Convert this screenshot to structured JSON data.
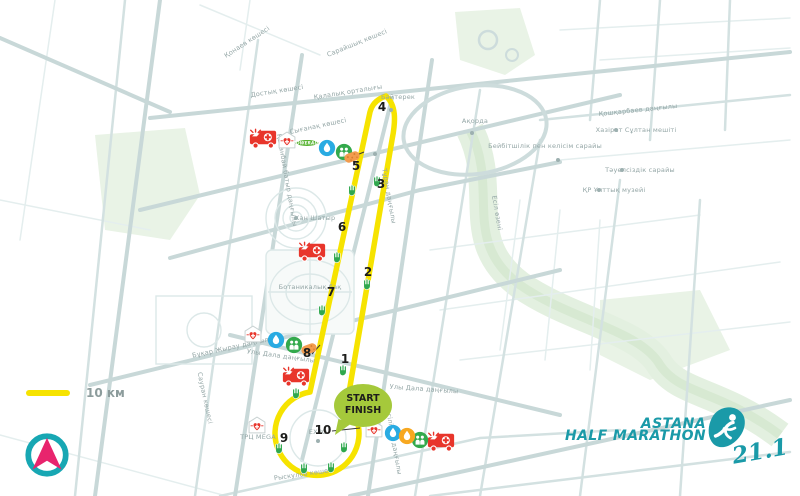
{
  "title": "Astana Half Marathon route map",
  "legend": {
    "distance_label": "10 км"
  },
  "branding": {
    "line1": "ASTANA",
    "line2": "HALF MARATHON",
    "distance": "21.1"
  },
  "start_finish": {
    "line1": "START",
    "line2": "FINISH"
  },
  "colors": {
    "route_yellow": "#F6E300",
    "brand_teal": "#1A9AA8",
    "compass_pink": "#E8246D",
    "bubble_green": "#A5C93B",
    "ambulance_red": "#E8352B",
    "water_blue": "#29ABE2",
    "people_green": "#33A94C",
    "orange": "#F7A821",
    "street_gray": "#CDDCDC"
  },
  "checkpoints": [
    {
      "n": "1",
      "x": 345,
      "y": 359
    },
    {
      "n": "2",
      "x": 368,
      "y": 272
    },
    {
      "n": "3",
      "x": 381,
      "y": 184
    },
    {
      "n": "4",
      "x": 382,
      "y": 107
    },
    {
      "n": "5",
      "x": 356,
      "y": 166
    },
    {
      "n": "6",
      "x": 342,
      "y": 227
    },
    {
      "n": "7",
      "x": 331,
      "y": 292
    },
    {
      "n": "8",
      "x": 307,
      "y": 353
    },
    {
      "n": "9",
      "x": 284,
      "y": 438
    },
    {
      "n": "10",
      "x": 323,
      "y": 430
    }
  ],
  "stations": [
    {
      "type": "ambulance",
      "x": 263,
      "y": 139
    },
    {
      "type": "ambulance",
      "x": 312,
      "y": 252
    },
    {
      "type": "ambulance",
      "x": 296,
      "y": 377
    },
    {
      "type": "ambulance",
      "x": 441,
      "y": 442
    },
    {
      "type": "medical",
      "x": 287,
      "y": 140
    },
    {
      "type": "medical",
      "x": 253,
      "y": 334
    },
    {
      "type": "medical",
      "x": 257,
      "y": 425
    },
    {
      "type": "medical",
      "x": 374,
      "y": 429
    },
    {
      "type": "powerade",
      "x": 307,
      "y": 143,
      "label": "POWERADE"
    },
    {
      "type": "water",
      "x": 327,
      "y": 148
    },
    {
      "type": "water",
      "x": 276,
      "y": 340
    },
    {
      "type": "water",
      "x": 393,
      "y": 433
    },
    {
      "type": "people",
      "x": 344,
      "y": 152
    },
    {
      "type": "people",
      "x": 294,
      "y": 345
    },
    {
      "type": "people",
      "x": 420,
      "y": 440
    },
    {
      "type": "iso",
      "x": 407,
      "y": 436
    },
    {
      "type": "sponge",
      "x": 352,
      "y": 157,
      "rot": -20
    },
    {
      "type": "sponge",
      "x": 309,
      "y": 349,
      "rot": -20
    },
    {
      "type": "hand",
      "x": 377,
      "y": 181
    },
    {
      "type": "hand",
      "x": 352,
      "y": 190
    },
    {
      "type": "hand",
      "x": 337,
      "y": 257
    },
    {
      "type": "hand",
      "x": 367,
      "y": 284
    },
    {
      "type": "hand",
      "x": 322,
      "y": 310
    },
    {
      "type": "hand",
      "x": 343,
      "y": 370
    },
    {
      "type": "hand",
      "x": 296,
      "y": 393
    },
    {
      "type": "hand",
      "x": 279,
      "y": 448
    },
    {
      "type": "hand",
      "x": 344,
      "y": 447
    },
    {
      "type": "hand",
      "x": 304,
      "y": 468
    },
    {
      "type": "hand",
      "x": 331,
      "y": 467
    }
  ],
  "map_labels": [
    {
      "text": "Қонаев көшесі",
      "x": 247,
      "y": 42,
      "rot": -33
    },
    {
      "text": "Достық көшесі",
      "x": 277,
      "y": 91,
      "rot": -9
    },
    {
      "text": "Қалалық орталығы",
      "x": 348,
      "y": 92,
      "rot": -9
    },
    {
      "text": "Сарайшық көшесі",
      "x": 357,
      "y": 43,
      "rot": -22
    },
    {
      "text": "Сығанақ көшесі",
      "x": 318,
      "y": 126,
      "rot": -12
    },
    {
      "text": "Қошқарбаев даңғылы",
      "x": 638,
      "y": 110,
      "rot": -6
    },
    {
      "text": "Қабанбай батыр даңғылы",
      "x": 287,
      "y": 180,
      "rot": 80
    },
    {
      "text": "Тұран даңғылы",
      "x": 389,
      "y": 196,
      "rot": 80
    },
    {
      "text": "Хан Шатыр",
      "x": 315,
      "y": 218,
      "rot": 0
    },
    {
      "text": "Бәйтерек",
      "x": 398,
      "y": 97,
      "rot": 0
    },
    {
      "text": "Ақорда",
      "x": 475,
      "y": 121,
      "rot": 0
    },
    {
      "text": "Есіл өзені",
      "x": 497,
      "y": 213,
      "rot": 80
    },
    {
      "text": "Бейбітшілік пен келісім сарайы",
      "x": 545,
      "y": 146,
      "rot": 0
    },
    {
      "text": "Хазірет Сұлтан мешіті",
      "x": 636,
      "y": 130,
      "rot": 0
    },
    {
      "text": "Тәуелсіздік сарайы",
      "x": 640,
      "y": 170,
      "rot": 0
    },
    {
      "text": "ҚР Ұлттық музейі",
      "x": 614,
      "y": 190,
      "rot": 0
    },
    {
      "text": "Ботаникалық бақ",
      "x": 310,
      "y": 287,
      "rot": 0
    },
    {
      "text": "Бұқар Жырау даңғылы",
      "x": 233,
      "y": 347,
      "rot": -12
    },
    {
      "text": "Улы Дала даңғылы",
      "x": 281,
      "y": 356,
      "rot": 8
    },
    {
      "text": "Улы Дала даңғылы",
      "x": 424,
      "y": 389,
      "rot": 4
    },
    {
      "text": "Мәңгілік Ел даңғылы",
      "x": 393,
      "y": 437,
      "rot": 80
    },
    {
      "text": "Сауран көшесі",
      "x": 205,
      "y": 398,
      "rot": 78
    },
    {
      "text": "ТРЦ MEGA",
      "x": 258,
      "y": 437,
      "rot": 0
    },
    {
      "text": "EXPO",
      "x": 318,
      "y": 432,
      "rot": 0
    },
    {
      "text": "Рыскулов көшесі",
      "x": 304,
      "y": 474,
      "rot": -8
    }
  ],
  "poi_dots": [
    {
      "x": 296,
      "y": 218
    },
    {
      "x": 391,
      "y": 110
    },
    {
      "x": 472,
      "y": 133
    },
    {
      "x": 558,
      "y": 160
    },
    {
      "x": 616,
      "y": 130
    },
    {
      "x": 622,
      "y": 170
    },
    {
      "x": 599,
      "y": 190
    },
    {
      "x": 318,
      "y": 441
    },
    {
      "x": 375,
      "y": 154
    }
  ]
}
